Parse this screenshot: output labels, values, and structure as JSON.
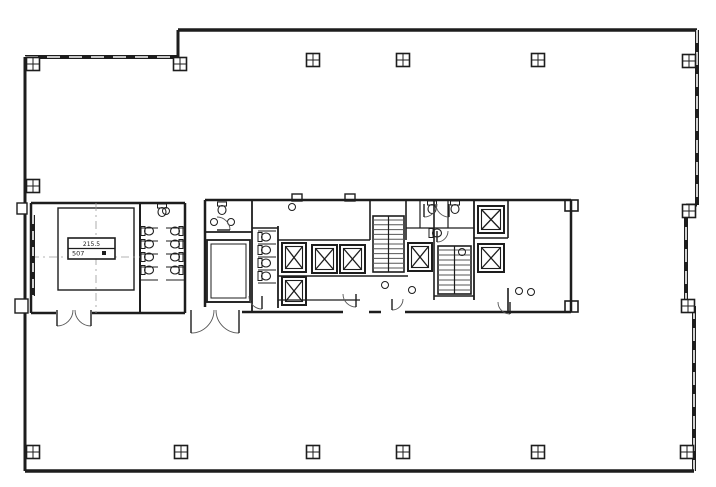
{
  "meta": {
    "drawing_type": "architectural-floor-plan",
    "description": "Office tower typical floor plan with central service core, elevators, scissor stairs, restrooms and open office space"
  },
  "tag": {
    "line1": "215.5",
    "line2": "507"
  },
  "geometry": {
    "canvas": {
      "w": 716,
      "h": 487
    },
    "colors": {
      "ink": "#1d1d1d",
      "mid": "#565656",
      "faint": "#9a9a9a",
      "bg": "#ffffff"
    },
    "outer_walls": [
      [
        25,
        57,
        178,
        57,
        4,
        true
      ],
      [
        178,
        57,
        178,
        30,
        3,
        false
      ],
      [
        178,
        30,
        697,
        30,
        3.5,
        false
      ],
      [
        697,
        30,
        697,
        205,
        4,
        true
      ],
      [
        697,
        205,
        686,
        205,
        3,
        false
      ],
      [
        686,
        205,
        686,
        306,
        4,
        true
      ],
      [
        686,
        306,
        694,
        306,
        3,
        false
      ],
      [
        694,
        306,
        694,
        471,
        4,
        true
      ],
      [
        694,
        471,
        25,
        471,
        3.5,
        false
      ],
      [
        25,
        471,
        25,
        57,
        3,
        false
      ]
    ],
    "pilasters": [
      [
        17,
        203,
        10,
        11
      ],
      [
        15,
        299,
        13,
        14
      ],
      [
        292,
        194,
        10,
        7
      ],
      [
        345,
        194,
        10,
        7
      ]
    ],
    "core_walls": [
      [
        31,
        203,
        185,
        203,
        2.5
      ],
      [
        185,
        203,
        185,
        313,
        2.5
      ],
      [
        185,
        313,
        31,
        313,
        2.5
      ],
      [
        31,
        313,
        31,
        203,
        2.5
      ],
      [
        140,
        203,
        140,
        313,
        2
      ],
      [
        205,
        200,
        571,
        200,
        2.5
      ],
      [
        571,
        200,
        571,
        312,
        2.5
      ],
      [
        571,
        312,
        205,
        312,
        2.5
      ],
      [
        205,
        312,
        205,
        200,
        2.5
      ],
      [
        252,
        200,
        252,
        312,
        1.8
      ],
      [
        205,
        232,
        252,
        232,
        1.8
      ],
      [
        205,
        302,
        252,
        302,
        1.6
      ],
      [
        252,
        228,
        278,
        228,
        1.6
      ],
      [
        278,
        226,
        278,
        308,
        1.8
      ],
      [
        278,
        240,
        370,
        240,
        1.6
      ],
      [
        278,
        276,
        408,
        276,
        1.6
      ],
      [
        278,
        300,
        360,
        300,
        1.2
      ],
      [
        370,
        200,
        370,
        240,
        1.6
      ],
      [
        406,
        200,
        406,
        240,
        1.6
      ],
      [
        434,
        200,
        434,
        300,
        1.6
      ],
      [
        434,
        296,
        474,
        296,
        1.6
      ],
      [
        474,
        200,
        474,
        300,
        1.8
      ],
      [
        474,
        238,
        508,
        238,
        1.4
      ],
      [
        508,
        200,
        508,
        238,
        1.6
      ],
      [
        508,
        288,
        508,
        312,
        1.6
      ],
      [
        420,
        200,
        420,
        228,
        1.2
      ],
      [
        448,
        200,
        448,
        228,
        1.2
      ],
      [
        406,
        228,
        474,
        228,
        1.2
      ],
      [
        141,
        228,
        158,
        228,
        1
      ],
      [
        141,
        241,
        158,
        241,
        1
      ],
      [
        141,
        254,
        158,
        254,
        1
      ],
      [
        141,
        267,
        158,
        267,
        1
      ],
      [
        141,
        280,
        158,
        280,
        1
      ],
      [
        166,
        228,
        184,
        228,
        1
      ],
      [
        166,
        241,
        184,
        241,
        1
      ],
      [
        166,
        254,
        184,
        254,
        1
      ],
      [
        166,
        267,
        184,
        267,
        1
      ],
      [
        166,
        280,
        184,
        280,
        1
      ],
      [
        258,
        231,
        276,
        231,
        1
      ],
      [
        258,
        244,
        276,
        244,
        1
      ],
      [
        258,
        257,
        276,
        257,
        1
      ],
      [
        258,
        270,
        276,
        270,
        1
      ],
      [
        258,
        283,
        276,
        283,
        1
      ]
    ],
    "wall_gaps": [
      [
        56,
        307,
        36,
        10
      ],
      [
        188,
        307,
        54,
        10
      ],
      [
        343,
        307,
        26,
        9
      ],
      [
        381,
        307,
        24,
        9
      ]
    ],
    "inner_rects": [
      [
        58,
        208,
        76,
        82,
        1.4
      ],
      [
        207,
        240,
        43,
        62,
        1.8
      ],
      [
        211,
        244,
        35,
        54,
        1
      ],
      [
        565,
        200,
        13,
        11,
        1.6
      ],
      [
        565,
        301,
        13,
        11,
        1.6
      ]
    ],
    "grid_lines": [
      [
        96,
        203,
        96,
        313
      ],
      [
        31,
        257,
        140,
        257
      ]
    ],
    "window_strips": [
      [
        33,
        215,
        33,
        296
      ]
    ],
    "columns": [
      [
        33,
        64
      ],
      [
        180,
        64
      ],
      [
        313,
        60
      ],
      [
        403,
        60
      ],
      [
        538,
        60
      ],
      [
        689,
        61
      ],
      [
        33,
        186
      ],
      [
        689,
        211
      ],
      [
        688,
        306
      ],
      [
        33,
        452
      ],
      [
        181,
        452
      ],
      [
        313,
        452
      ],
      [
        403,
        452
      ],
      [
        538,
        452
      ],
      [
        687,
        452
      ]
    ],
    "elevators": [
      [
        282,
        243,
        24,
        29
      ],
      [
        282,
        277,
        24,
        28
      ],
      [
        312,
        245,
        25,
        28
      ],
      [
        340,
        245,
        25,
        28
      ],
      [
        408,
        243,
        24,
        28
      ],
      [
        478,
        206,
        26,
        27
      ],
      [
        478,
        244,
        26,
        28
      ]
    ],
    "stairs": [
      [
        373,
        216,
        31,
        56,
        11
      ],
      [
        438,
        246,
        33,
        48,
        9
      ]
    ],
    "toilets": [
      [
        149,
        231,
        0
      ],
      [
        149,
        244,
        0
      ],
      [
        149,
        257,
        0
      ],
      [
        149,
        270,
        0
      ],
      [
        175,
        231,
        180
      ],
      [
        175,
        244,
        180
      ],
      [
        175,
        257,
        180
      ],
      [
        175,
        270,
        180
      ],
      [
        266,
        237,
        0
      ],
      [
        266,
        250,
        0
      ],
      [
        266,
        263,
        0
      ],
      [
        266,
        276,
        0
      ],
      [
        222,
        210,
        90
      ],
      [
        432,
        209,
        90
      ],
      [
        455,
        209,
        90
      ],
      [
        437,
        233,
        0
      ],
      [
        162,
        212,
        90
      ]
    ],
    "sinks": [
      [
        214,
        222
      ],
      [
        231,
        222
      ],
      [
        292,
        207
      ],
      [
        385,
        285
      ],
      [
        412,
        290
      ],
      [
        462,
        252
      ],
      [
        519,
        291
      ],
      [
        531,
        292
      ],
      [
        166,
        211
      ]
    ],
    "doors": [
      [
        57,
        310,
        16,
        0,
        90
      ],
      [
        91,
        310,
        16,
        180,
        90
      ],
      [
        191,
        310,
        23,
        0,
        90
      ],
      [
        239,
        310,
        23,
        180,
        90
      ],
      [
        217,
        230,
        13,
        270,
        360
      ],
      [
        262,
        296,
        13,
        180,
        90
      ],
      [
        356,
        294,
        13,
        180,
        90
      ],
      [
        392,
        299,
        11,
        0,
        90
      ],
      [
        424,
        204,
        13,
        0,
        90
      ],
      [
        449,
        204,
        13,
        180,
        90
      ],
      [
        437,
        231,
        11,
        0,
        90
      ],
      [
        510,
        302,
        12,
        180,
        90
      ]
    ],
    "tag_box": {
      "x": 68,
      "y": 238,
      "w": 47,
      "h": 21
    }
  }
}
